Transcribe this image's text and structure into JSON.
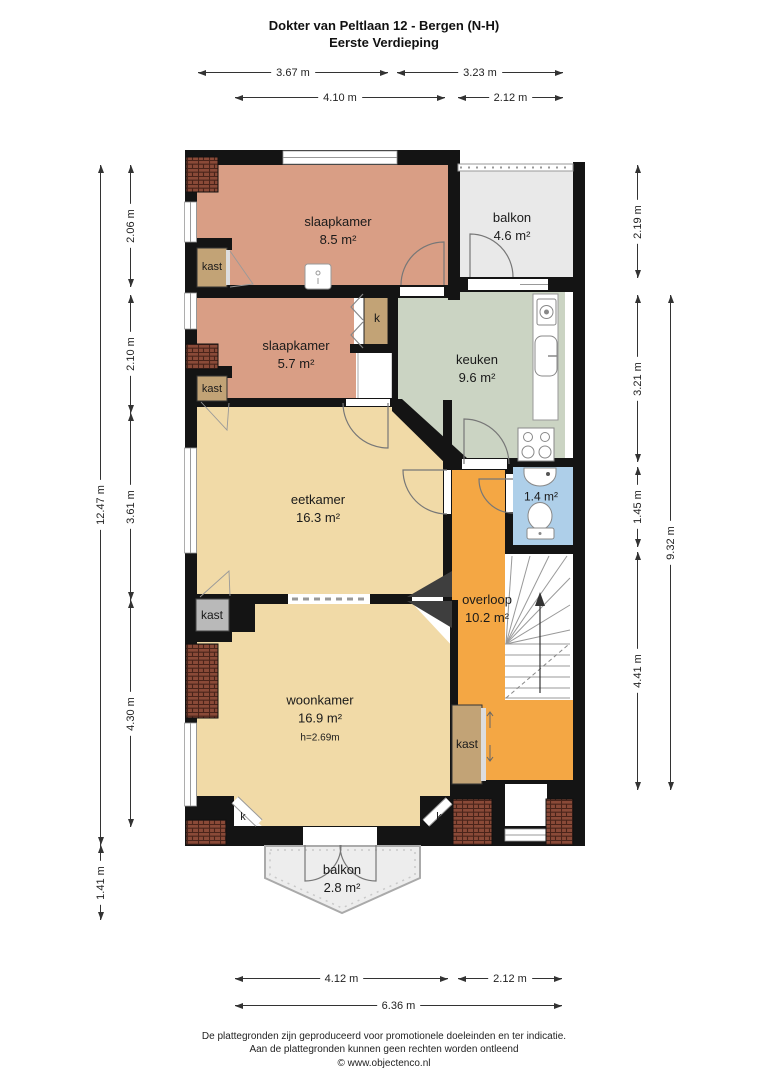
{
  "title": {
    "line1": "Dokter van Peltlaan 12 - Bergen (N-H)",
    "line2": "Eerste Verdieping"
  },
  "dims": {
    "top": {
      "d367": "3.67 m",
      "d323": "3.23 m",
      "d410": "4.10 m",
      "d212": "2.12 m"
    },
    "left": {
      "d206": "2.06 m",
      "d210": "2.10 m",
      "d361": "3.61 m",
      "d430": "4.30 m",
      "d1247": "12.47 m",
      "d141": "1.41 m"
    },
    "right": {
      "d219": "2.19 m",
      "d321": "3.21 m",
      "d145": "1.45 m",
      "d441": "4.41 m",
      "d932": "9.32 m"
    },
    "bottom": {
      "d412": "4.12 m",
      "d212": "2.12 m",
      "d636": "6.36 m"
    }
  },
  "rooms": {
    "slaapkamer1": {
      "name": "slaapkamer",
      "area": "8.5 m²"
    },
    "balkon_boven": {
      "name": "balkon",
      "area": "4.6 m²"
    },
    "slaapkamer2": {
      "name": "slaapkamer",
      "area": "5.7 m²"
    },
    "keuken": {
      "name": "keuken",
      "area": "9.6 m²"
    },
    "eetkamer": {
      "name": "eetkamer",
      "area": "16.3 m²"
    },
    "toilet": {
      "area": "1.4 m²"
    },
    "overloop": {
      "name": "overloop",
      "area": "10.2 m²"
    },
    "woonkamer": {
      "name": "woonkamer",
      "area": "16.9 m²",
      "height": "h=2.69m"
    },
    "balkon_beneden": {
      "name": "balkon",
      "area": "2.8 m²"
    }
  },
  "closets": {
    "kast_label": "kast",
    "k_label": "k"
  },
  "footer": {
    "line1": "De plattegronden zijn geproduceerd voor promotionele doeleinden en ter indicatie.",
    "line2": "Aan de plattegronden kunnen geen rechten worden ontleend",
    "line3": "© www.objectenco.nl"
  },
  "colors": {
    "wall": "#141414",
    "bedroom_salmon": "#d99e85",
    "living_tan": "#f1daa7",
    "kitchen_sage": "#cbd4c3",
    "landing_orange": "#f4a744",
    "toilet_blue": "#aecfe9",
    "balcony_gray": "#e9e9e9",
    "closet_tan": "#c2a376",
    "closet_gray": "#b9b9b9",
    "roof_tiles": "#8a4a38",
    "chimney_gray": "#3e3e3e"
  }
}
